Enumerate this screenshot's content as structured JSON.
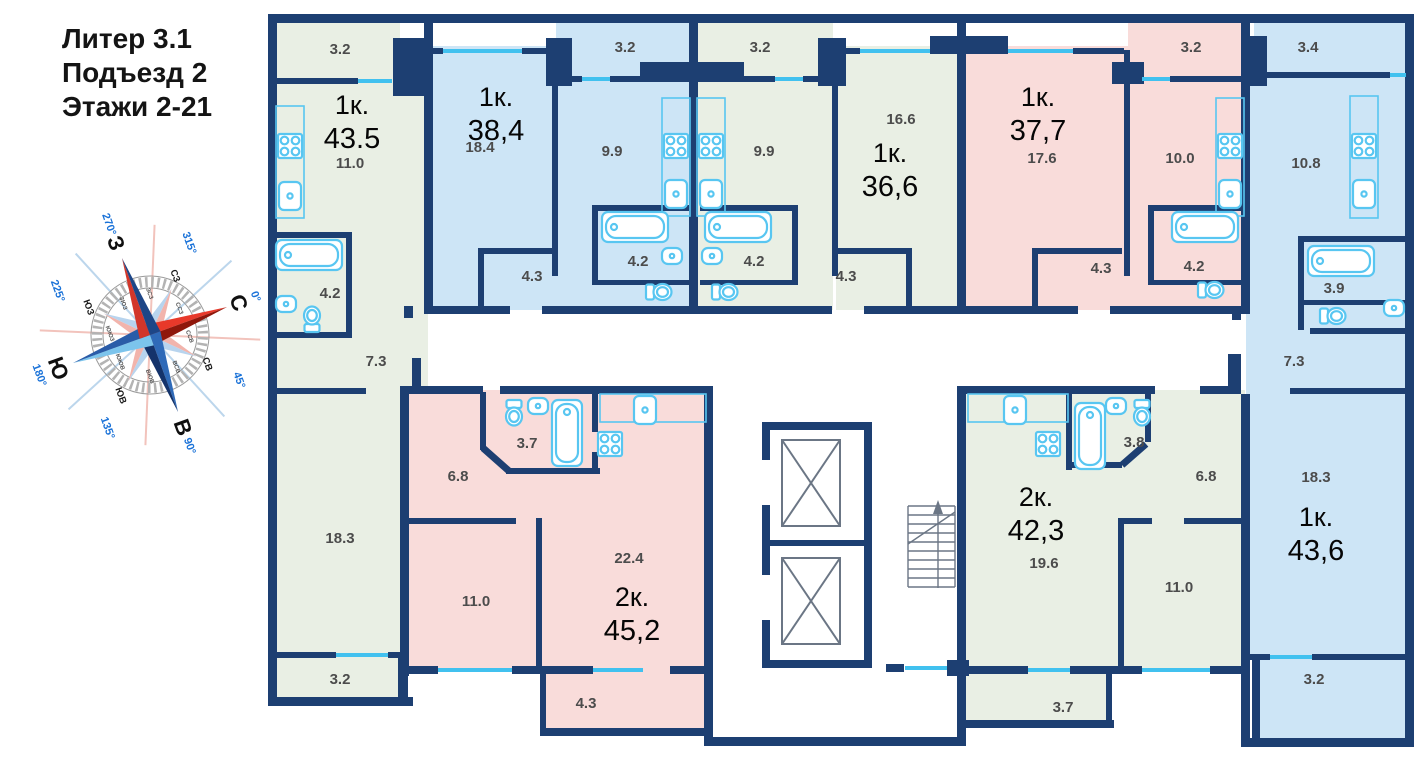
{
  "header": {
    "building": "Литер 3.1",
    "entrance": "Подъезд 2",
    "floors": "Этажи 2-21"
  },
  "compass": {
    "cardinals": {
      "n": "С",
      "e": "В",
      "s": "Ю",
      "w": "З"
    },
    "intercardinals": {
      "nw": "СЗ",
      "ne": "СВ",
      "se": "ЮВ",
      "sw": "ЮЗ"
    },
    "degrees": {
      "n": "0°",
      "ne": "45°",
      "e": "90°",
      "se": "135°",
      "s": "180°",
      "sw": "225°",
      "w": "270°",
      "nw": "315°"
    },
    "ring": [
      "ССЗ",
      "ССВ",
      "ВСВ",
      "ВЮВ",
      "ЮЮВ",
      "ЮЮЗ",
      "ЗЮЗ",
      "ЗСЗ"
    ]
  },
  "plan": {
    "wall_color": "#1d3f72",
    "window_color": "#41c1ef",
    "fixture_color": "#58c6f1",
    "core_line_color": "#6b7685"
  },
  "apartments": [
    {
      "name": "apartment-1",
      "type": "1к.",
      "area": "43.5",
      "fill": "#e9efe4",
      "rooms": [
        {
          "name": "balcony-top",
          "area": "3.2"
        },
        {
          "name": "kitchen",
          "area": "11.0"
        },
        {
          "name": "bathroom",
          "area": "4.2"
        },
        {
          "name": "hall",
          "area": "7.3"
        },
        {
          "name": "living-room",
          "area": "18.3"
        },
        {
          "name": "balcony-bottom",
          "area": "3.2"
        }
      ]
    },
    {
      "name": "apartment-2",
      "type": "1к.",
      "area": "38,4",
      "fill": "#cde5f6",
      "rooms": [
        {
          "name": "living-room",
          "area": "18.4"
        },
        {
          "name": "balcony",
          "area": "3.2"
        },
        {
          "name": "kitchen",
          "area": "9.9"
        },
        {
          "name": "bathroom",
          "area": "4.2"
        },
        {
          "name": "hall",
          "area": "4.3"
        }
      ]
    },
    {
      "name": "apartment-3",
      "type": "1к.",
      "area": "36,6",
      "fill": "#e9efe4",
      "rooms": [
        {
          "name": "living-room",
          "area": "16.6"
        },
        {
          "name": "balcony",
          "area": "3.2"
        },
        {
          "name": "kitchen",
          "area": "9.9"
        },
        {
          "name": "bathroom",
          "area": "4.2"
        },
        {
          "name": "hall",
          "area": "4.3"
        }
      ]
    },
    {
      "name": "apartment-4",
      "type": "1к.",
      "area": "37,7",
      "fill": "#f9dcda",
      "rooms": [
        {
          "name": "living-room",
          "area": "17.6"
        },
        {
          "name": "balcony",
          "area": "3.2"
        },
        {
          "name": "kitchen",
          "area": "10.0"
        },
        {
          "name": "bathroom",
          "area": "4.2"
        },
        {
          "name": "hall",
          "area": "4.3"
        }
      ]
    },
    {
      "name": "apartment-5",
      "type": "1к.",
      "area": "43,6",
      "fill": "#cde5f6",
      "rooms": [
        {
          "name": "balcony-top",
          "area": "3.4"
        },
        {
          "name": "kitchen",
          "area": "10.8"
        },
        {
          "name": "bathroom",
          "area": "3.9"
        },
        {
          "name": "hall",
          "area": "7.3"
        },
        {
          "name": "living-room",
          "area": "18.3"
        },
        {
          "name": "balcony-bottom",
          "area": "3.2"
        }
      ]
    },
    {
      "name": "apartment-6",
      "type": "2к.",
      "area": "45,2",
      "fill": "#f9dcda",
      "rooms": [
        {
          "name": "hall",
          "area": "6.8"
        },
        {
          "name": "bathroom",
          "area": "3.7"
        },
        {
          "name": "bedroom",
          "area": "11.0"
        },
        {
          "name": "living-kitchen",
          "area": "22.4"
        },
        {
          "name": "balcony",
          "area": "4.3"
        }
      ]
    },
    {
      "name": "apartment-7",
      "type": "2к.",
      "area": "42,3",
      "fill": "#e9efe4",
      "rooms": [
        {
          "name": "bathroom",
          "area": "3.8"
        },
        {
          "name": "hall",
          "area": "6.8"
        },
        {
          "name": "living-kitchen",
          "area": "19.6"
        },
        {
          "name": "bedroom",
          "area": "11.0"
        },
        {
          "name": "balcony",
          "area": "3.7"
        }
      ]
    }
  ]
}
